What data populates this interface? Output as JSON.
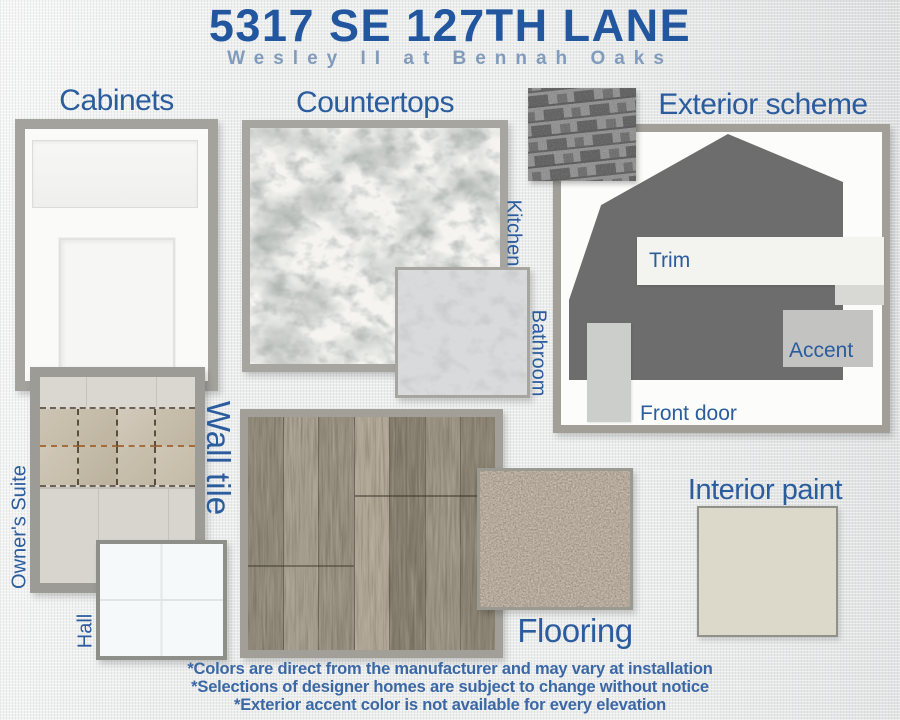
{
  "header": {
    "title": "5317 SE 127TH LANE",
    "subtitle": "Wesley II at Bennah Oaks"
  },
  "sections": {
    "cabinets": {
      "heading": "Cabinets"
    },
    "countertops": {
      "heading": "Countertops",
      "kitchen_label": "Kitchen",
      "bathroom_label": "Bathroom"
    },
    "exterior": {
      "heading": "Exterior scheme",
      "trim_label": "Trim",
      "accent_label": "Accent",
      "front_door_label": "Front door"
    },
    "wall_tile": {
      "heading": "Wall tile",
      "owners_suite_label": "Owner's Suite",
      "hall_label": "Hall"
    },
    "flooring": {
      "heading": "Flooring"
    },
    "interior_paint": {
      "heading": "Interior paint"
    }
  },
  "footnotes": [
    "*Colors are direct from the manufacturer and may vary at installation",
    "*Selections of designer homes are subject to change without notice",
    "*Exterior accent color is not available for every elevation"
  ],
  "colors": {
    "title_blue": "#2257a0",
    "heading_blue": "#2a5c9e",
    "subtitle_blue": "#819cbb",
    "footnote_blue": "#3b68a5",
    "frame_gray": "#a19f98",
    "house_gray": "#6d6d6d",
    "trim_white": "#f3f3ef",
    "accent_gray": "#c3c4c2",
    "front_door_gray": "#cccecb",
    "interior_paint_greige": "#dcd8ca",
    "bathroom_counter_gray": "#d9dadb",
    "carpet_taupe": "#b5a99b"
  }
}
